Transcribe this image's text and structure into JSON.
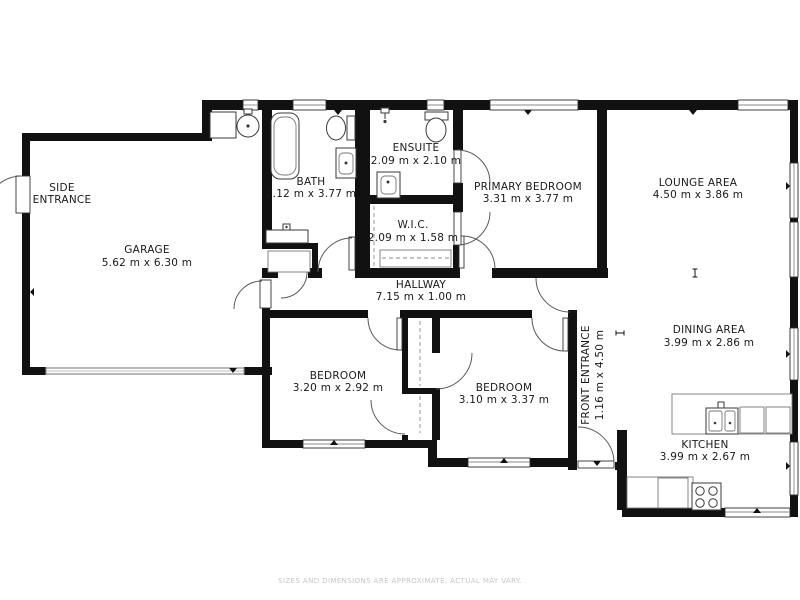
{
  "plan": {
    "rooms": {
      "side_entrance": {
        "name_line1": "SIDE",
        "name_line2": "ENTRANCE"
      },
      "garage": {
        "name": "GARAGE",
        "dims": "5.62 m x 6.30 m"
      },
      "bath": {
        "name": "BATH",
        "dims": "2.12 m x 3.77 m"
      },
      "ensuite": {
        "name": "ENSUITE",
        "dims": "2.09 m x 2.10 m"
      },
      "wic": {
        "name": "W.I.C.",
        "dims": "2.09 m x 1.58 m"
      },
      "primary_bedroom": {
        "name": "PRIMARY BEDROOM",
        "dims": "3.31 m x 3.77 m"
      },
      "lounge": {
        "name": "LOUNGE AREA",
        "dims": "4.50 m x 3.86 m"
      },
      "hallway": {
        "name": "HALLWAY",
        "dims": "7.15 m x 1.00 m"
      },
      "dining": {
        "name": "DINING AREA",
        "dims": "3.99 m x 2.86 m"
      },
      "bedroom1": {
        "name": "BEDROOM",
        "dims": "3.20 m x 2.92 m"
      },
      "bedroom2": {
        "name": "BEDROOM",
        "dims": "3.10 m x 3.37 m"
      },
      "front_entrance": {
        "name": "FRONT ENTRANCE",
        "dims": "1.16 m x 4.50 m"
      },
      "kitchen": {
        "name": "KITCHEN",
        "dims": "3.99 m x 2.67 m"
      }
    },
    "footer": "SIZES AND DIMENSIONS ARE APPROXIMATE, ACTUAL MAY VARY.",
    "colors": {
      "wall": "#111111",
      "background": "#ffffff",
      "door_arc": "#5a5a5a",
      "garage_door": "#8a8a8a",
      "footer_text": "#c6c6c6"
    }
  }
}
